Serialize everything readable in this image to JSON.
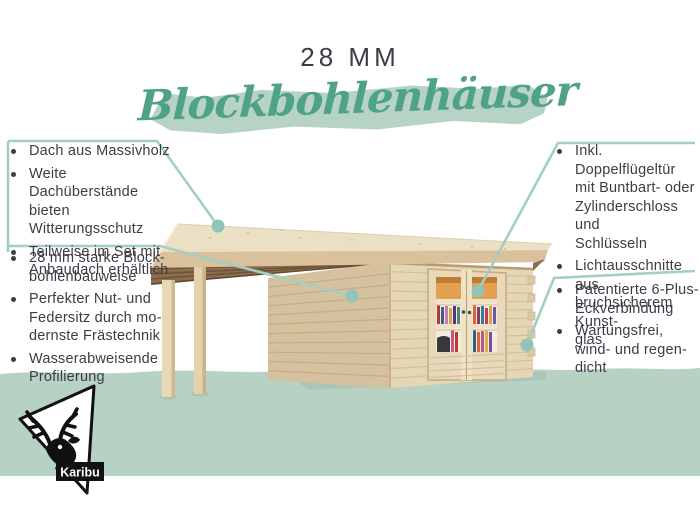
{
  "header": {
    "thickness_label": "28 MM",
    "title": "Blockbohlenhäuser"
  },
  "features": {
    "left_top": [
      {
        "lines": [
          "Dach aus Massivholz"
        ]
      },
      {
        "lines": [
          "Weite Dachüberstände",
          "bieten Witterungsschutz"
        ]
      },
      {
        "lines": [
          "Teilweise im Set mit",
          "Anbaudach erhältlich"
        ]
      }
    ],
    "left_bottom": [
      {
        "lines": [
          "28 mm starke Block-",
          "bohlenbauweise"
        ]
      },
      {
        "lines": [
          "Perfekter Nut- und",
          "Federsitz durch mo-",
          "dernste Frästechnik"
        ]
      },
      {
        "lines": [
          "Wasserabweisende",
          "Profilierung"
        ]
      }
    ],
    "right_top": [
      {
        "lines": [
          "Inkl. Doppelflügeltür",
          "mit Buntbart- oder",
          "Zylinderschloss und",
          "Schlüsseln"
        ]
      },
      {
        "lines": [
          "Lichtausschnitte aus",
          "bruchsicherem Kunst-",
          "glas"
        ]
      }
    ],
    "right_bottom": [
      {
        "lines": [
          "Patentierte 6-Plus-",
          "Eckverbindung"
        ]
      },
      {
        "lines": [
          "Wartungsfrei,",
          "wind- und regen-",
          "dicht"
        ]
      }
    ]
  },
  "logo": {
    "brand": "Karibu"
  },
  "colors": {
    "accent_green": "#4fa286",
    "brush_green": "#b6d3c5",
    "band_green": "#b7d1c3",
    "callout_line": "#a3cfc3",
    "callout_dot": "#8fc6b9",
    "text_dark": "#3c3c47"
  }
}
